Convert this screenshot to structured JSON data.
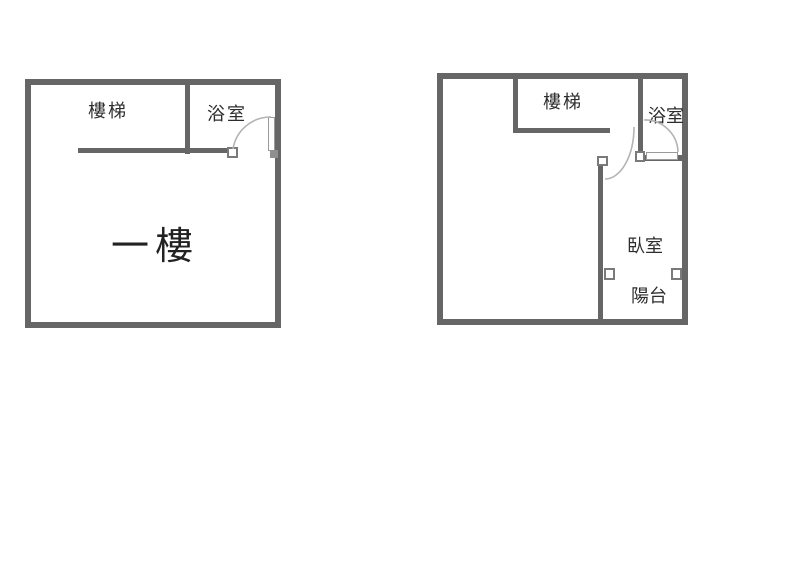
{
  "document": {
    "kind": "floor-plan-drawing",
    "floors_shown": 2
  },
  "colors": {
    "wall": "#666666",
    "door_arc": "#b3b3b3",
    "text": "#2d2d2d",
    "background": "#ffffff"
  },
  "floor1": {
    "name_label": "一樓",
    "rooms": {
      "stairs": "樓梯",
      "bathroom": "浴室"
    }
  },
  "floor2": {
    "rooms": {
      "stairs": "樓梯",
      "bathroom": "浴室",
      "bedroom": "臥室",
      "balcony": "陽台"
    }
  }
}
